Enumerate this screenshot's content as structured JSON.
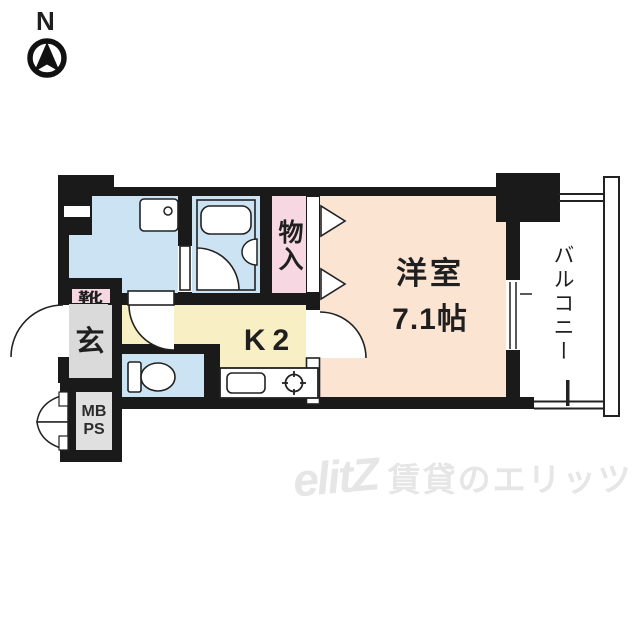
{
  "compass": {
    "label": "N"
  },
  "rooms": {
    "western": {
      "name": "洋室",
      "size": "7.1帖"
    },
    "kitchen": {
      "label": "K2"
    },
    "closet": {
      "label": "物入"
    },
    "balcony": {
      "label": "バルコニー"
    },
    "entrance": {
      "label": "玄"
    },
    "shoebox": {
      "label": "靴"
    },
    "meterbox": {
      "line1": "MB",
      "line2": "PS"
    }
  },
  "watermark": {
    "logo": "elitZ",
    "text": "賃貸のエリッツ"
  },
  "colors": {
    "wall": "#1a1a1a",
    "wet_area_blue": "#cbe3f3",
    "room_peach": "#fce4d2",
    "kitchen_yellow": "#f9efc5",
    "closet_pink": "#f6d7e2",
    "entry_gray": "#dadada",
    "watermark_gray": "#e6e6e6"
  }
}
